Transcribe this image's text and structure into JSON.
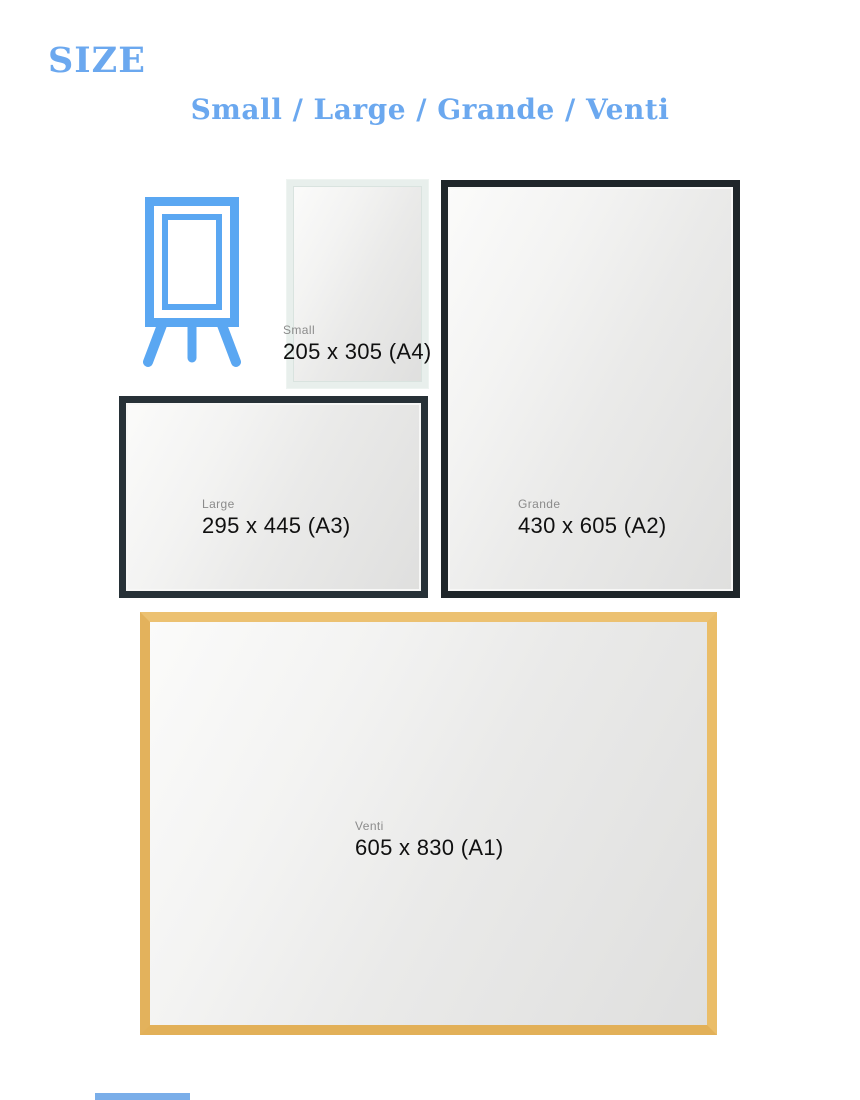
{
  "page": {
    "title": "SIZE",
    "subtitle": "Small / Large / Grande / Venti"
  },
  "colors": {
    "accent_blue": "#6BA8EF",
    "easel_blue": "#5AA7F2",
    "frame_dark": "#232C31",
    "frame_gold": "#E7B863",
    "frame_mint": "#E8EFEC",
    "label_gray": "#8B8B8B",
    "dims_black": "#101010"
  },
  "icons": {
    "easel": "easel-icon"
  },
  "sizes": [
    {
      "id": "small",
      "name": "Small",
      "dimensions": "205 x 305 (A4)"
    },
    {
      "id": "large",
      "name": "Large",
      "dimensions": "295 x 445 (A3)"
    },
    {
      "id": "grande",
      "name": "Grande",
      "dimensions": "430 x 605 (A2)"
    },
    {
      "id": "venti",
      "name": "Venti",
      "dimensions": "605 x 830 (A1)"
    }
  ]
}
